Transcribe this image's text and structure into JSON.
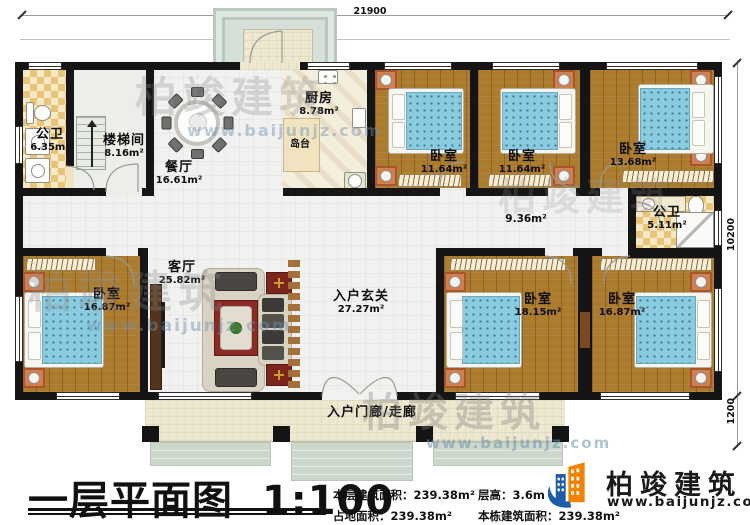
{
  "dims": {
    "top": "21900",
    "right": "10200",
    "porch": "1200"
  },
  "rooms": {
    "bath1": {
      "name": "公卫",
      "area": "6.35m²"
    },
    "stairwell": {
      "name": "楼梯间",
      "area": "8.16m²"
    },
    "dining": {
      "name": "餐厅",
      "area": "16.61m²"
    },
    "kitchen": {
      "name": "厨房",
      "area": "8.78m²"
    },
    "island": {
      "name": "岛台"
    },
    "bedroom_top_1": {
      "name": "卧室",
      "area": "11.64m²"
    },
    "bedroom_top_2": {
      "name": "卧室",
      "area": "11.64m²"
    },
    "bedroom_top_3": {
      "name": "卧室",
      "area": "13.68m²"
    },
    "bath2": {
      "name": "公卫",
      "area": "5.11m²"
    },
    "hallway": {
      "area": "9.36m²"
    },
    "living": {
      "name": "客厅",
      "area": "25.82m²"
    },
    "bedroom_bl": {
      "name": "卧室",
      "area": "16.87m²"
    },
    "foyer": {
      "name": "入户玄关",
      "area": "27.27m²"
    },
    "bedroom_b1": {
      "name": "卧室",
      "area": "18.15m²"
    },
    "bedroom_b2": {
      "name": "卧室",
      "area": "16.87m²"
    },
    "porch": {
      "name": "入户门廊/走廊"
    }
  },
  "footer": {
    "title": "一层平面图",
    "scale": "1:100",
    "stats": [
      {
        "label": "本层建筑面积：",
        "value": "239.38m²"
      },
      {
        "label": "占地面积：",
        "value": "239.38m²"
      },
      {
        "label": "层高：",
        "value": "3.6m"
      },
      {
        "label": "本栋建筑面积：",
        "value": "239.38m²"
      }
    ],
    "brand": {
      "name": "柏竣建筑",
      "url": "www.baijunjz.com"
    }
  },
  "watermark": {
    "name": "柏竣建筑",
    "url": "www.baijunjz.com"
  },
  "colors": {
    "wall": "#151515",
    "wood": "#ab7b2e",
    "mattress": "#86c9de",
    "checker": "#e9c67c",
    "brand_blue": "#1e5ca8",
    "brand_orange": "#f08300",
    "rug": "#8c2b24"
  }
}
